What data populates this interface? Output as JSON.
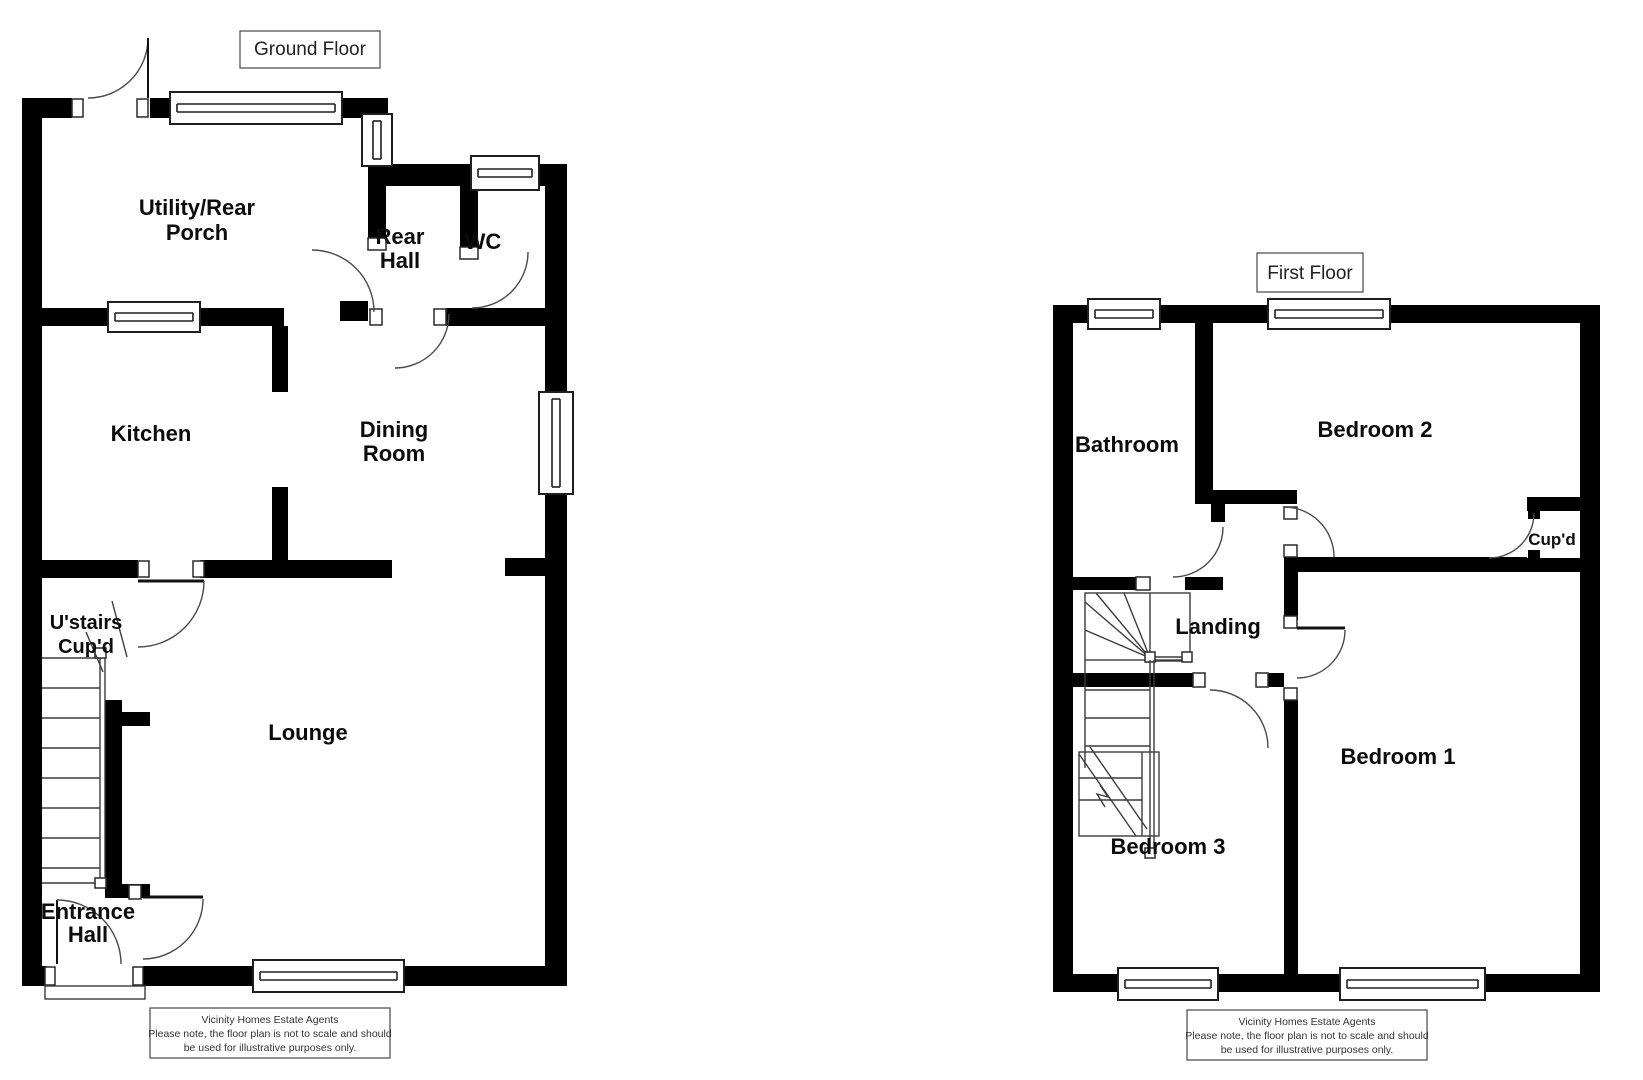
{
  "ground_floor": {
    "title": "Ground Floor",
    "rooms": {
      "utility": {
        "line1": "Utility/Rear",
        "line2": "Porch"
      },
      "rear_hall": {
        "line1": "Rear",
        "line2": "Hall"
      },
      "wc": "WC",
      "kitchen": "Kitchen",
      "dining": {
        "line1": "Dining",
        "line2": "Room"
      },
      "stairs_cupboard": {
        "line1": "U'stairs",
        "line2": "Cup'd"
      },
      "lounge": "Lounge",
      "entrance": {
        "line1": "Entrance",
        "line2": "Hall"
      }
    }
  },
  "first_floor": {
    "title": "First Floor",
    "rooms": {
      "bathroom": "Bathroom",
      "bedroom2": "Bedroom 2",
      "cupboard": "Cup'd",
      "landing": "Landing",
      "bedroom3": "Bedroom 3",
      "bedroom1": "Bedroom 1"
    }
  },
  "disclaimer": {
    "line1": "Vicinity Homes Estate Agents",
    "line2": "Please note, the floor plan is not to scale and should",
    "line3": "be used for illustrative purposes only."
  },
  "colors": {
    "wall": "#000000",
    "line": "#3c3c3c",
    "background": "#ffffff"
  }
}
